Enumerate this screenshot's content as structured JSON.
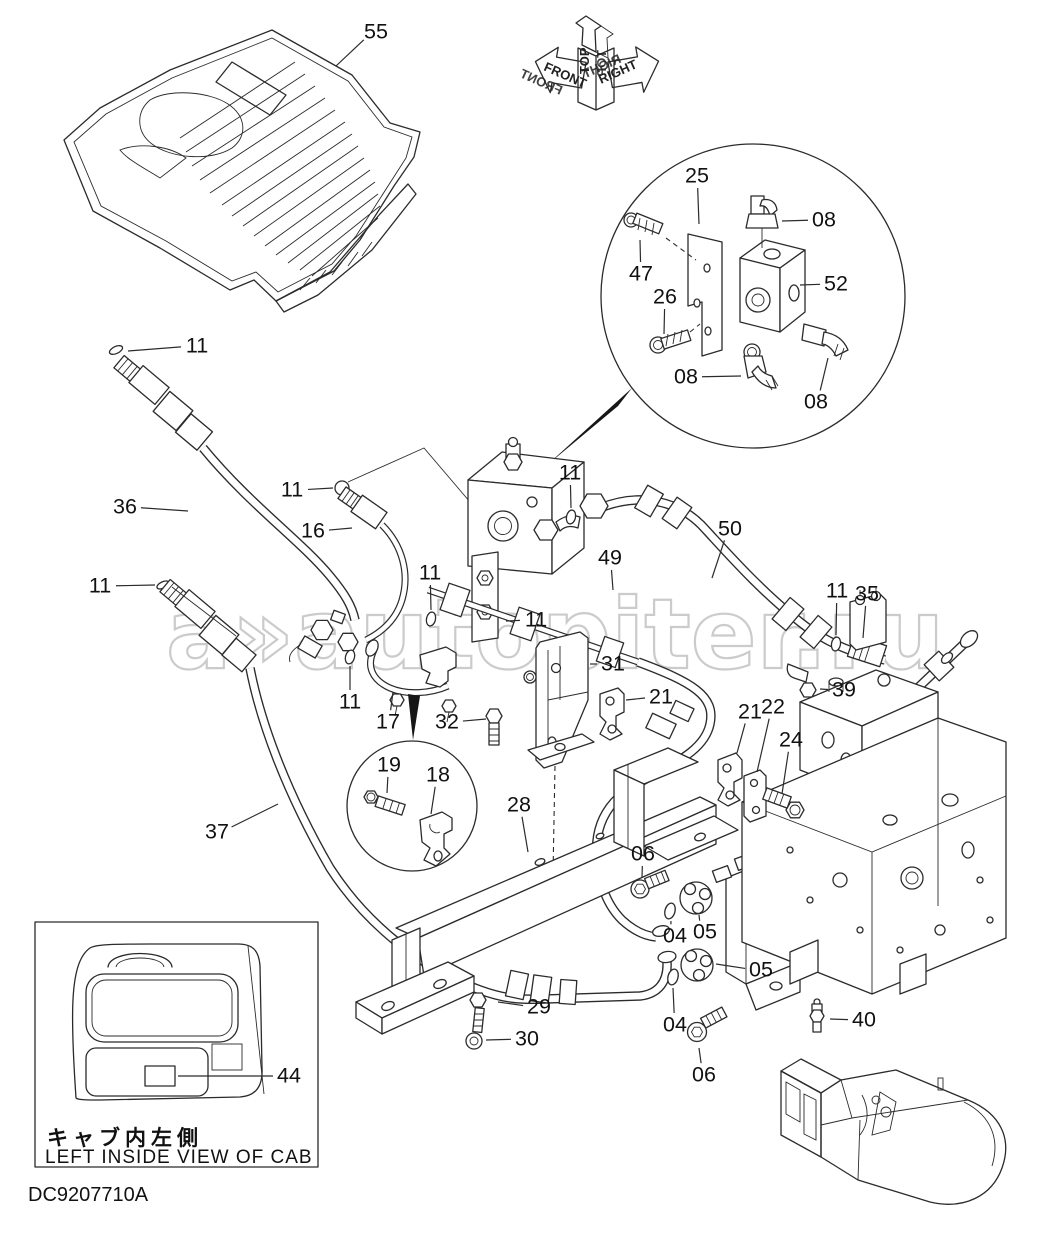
{
  "document": {
    "drawing_number": "DC9207710A"
  },
  "watermark": {
    "logo": "a»",
    "text": "autopiter.ru"
  },
  "orientation": {
    "top": "TOP",
    "front": "FRONT",
    "right": "RIGHT"
  },
  "inset": {
    "caption_jp": "キャブ内左側",
    "caption_en": "LEFT  INSIDE  VIEW  OF  CAB"
  },
  "callouts": [
    {
      "text": "55",
      "x": 376,
      "y": 32,
      "ex": 336,
      "ey": 66
    },
    {
      "text": "25",
      "x": 697,
      "y": 176,
      "ex": 699,
      "ey": 224
    },
    {
      "text": "08",
      "x": 824,
      "y": 220,
      "ex": 782,
      "ey": 221
    },
    {
      "text": "47",
      "x": 641,
      "y": 274,
      "ex": 640,
      "ey": 240
    },
    {
      "text": "26",
      "x": 665,
      "y": 297,
      "ex": 664,
      "ey": 334
    },
    {
      "text": "52",
      "x": 836,
      "y": 284,
      "ex": 800,
      "ey": 285
    },
    {
      "text": "08",
      "x": 686,
      "y": 377,
      "ex": 741,
      "ey": 376
    },
    {
      "text": "08",
      "x": 816,
      "y": 402,
      "ex": 828,
      "ey": 358
    },
    {
      "text": "11",
      "x": 197,
      "y": 346,
      "ex": 128,
      "ey": 351
    },
    {
      "text": "36",
      "x": 125,
      "y": 507,
      "ex": 188,
      "ey": 511
    },
    {
      "text": "11",
      "x": 292,
      "y": 490,
      "ex": 333,
      "ey": 488
    },
    {
      "text": "16",
      "x": 313,
      "y": 531,
      "ex": 352,
      "ey": 528
    },
    {
      "text": "11",
      "x": 100,
      "y": 586,
      "ex": 155,
      "ey": 585
    },
    {
      "text": "11",
      "x": 430,
      "y": 573,
      "ex": 431,
      "ey": 610
    },
    {
      "text": "11",
      "x": 570,
      "y": 473,
      "ex": 571,
      "ey": 508
    },
    {
      "text": "49",
      "x": 610,
      "y": 558,
      "ex": 613,
      "ey": 590
    },
    {
      "text": "50",
      "x": 730,
      "y": 529,
      "ex": 712,
      "ey": 578
    },
    {
      "text": "11",
      "x": 837,
      "y": 591,
      "ex": 836,
      "ey": 635
    },
    {
      "text": "35",
      "x": 867,
      "y": 594,
      "ex": 863,
      "ey": 638
    },
    {
      "text": "11",
      "x": 536,
      "y": 620,
      "ex": 506,
      "ey": 621
    },
    {
      "text": "31",
      "x": 613,
      "y": 664,
      "ex": 590,
      "ey": 664
    },
    {
      "text": "21",
      "x": 661,
      "y": 697,
      "ex": 626,
      "ey": 700
    },
    {
      "text": "32",
      "x": 447,
      "y": 722,
      "ex": 486,
      "ey": 719
    },
    {
      "text": "11",
      "x": 350,
      "y": 702,
      "ex": 350,
      "ey": 666
    },
    {
      "text": "17",
      "x": 388,
      "y": 722,
      "ex": 393,
      "ey": 692
    },
    {
      "text": "19",
      "x": 389,
      "y": 765,
      "ex": 387,
      "ey": 793
    },
    {
      "text": "18",
      "x": 438,
      "y": 775,
      "ex": 431,
      "ey": 814
    },
    {
      "text": "37",
      "x": 217,
      "y": 832,
      "ex": 278,
      "ey": 804
    },
    {
      "text": "28",
      "x": 519,
      "y": 805,
      "ex": 528,
      "ey": 852
    },
    {
      "text": "29",
      "x": 539,
      "y": 1007,
      "ex": 498,
      "ey": 1002
    },
    {
      "text": "30",
      "x": 527,
      "y": 1039,
      "ex": 486,
      "ey": 1040
    },
    {
      "text": "06",
      "x": 643,
      "y": 854,
      "ex": 642,
      "ey": 878
    },
    {
      "text": "04",
      "x": 675,
      "y": 936,
      "ex": 671,
      "ey": 921
    },
    {
      "text": "05",
      "x": 705,
      "y": 932,
      "ex": 699,
      "ey": 915
    },
    {
      "text": "05",
      "x": 761,
      "y": 970,
      "ex": 716,
      "ey": 964
    },
    {
      "text": "04",
      "x": 675,
      "y": 1025,
      "ex": 673,
      "ey": 988
    },
    {
      "text": "06",
      "x": 704,
      "y": 1075,
      "ex": 699,
      "ey": 1048
    },
    {
      "text": "40",
      "x": 864,
      "y": 1020,
      "ex": 830,
      "ey": 1019
    },
    {
      "text": "39",
      "x": 844,
      "y": 690,
      "ex": 820,
      "ey": 689
    },
    {
      "text": "21",
      "x": 750,
      "y": 712,
      "ex": 737,
      "ey": 753
    },
    {
      "text": "22",
      "x": 773,
      "y": 707,
      "ex": 757,
      "ey": 772
    },
    {
      "text": "24",
      "x": 791,
      "y": 740,
      "ex": 782,
      "ey": 794
    },
    {
      "text": "44",
      "x": 289,
      "y": 1076,
      "ex": 178,
      "ey": 1076
    }
  ]
}
